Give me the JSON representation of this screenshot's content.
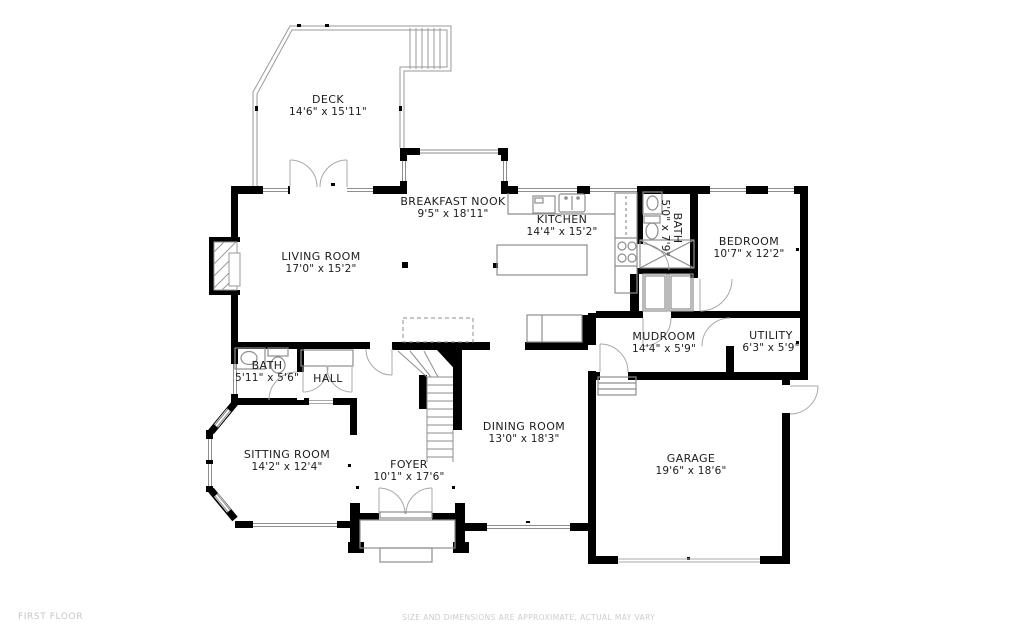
{
  "plan": {
    "floor_label": "FIRST FLOOR",
    "disclaimer": "SIZE AND DIMENSIONS ARE APPROXIMATE, ACTUAL MAY VARY"
  },
  "rooms": [
    {
      "id": "deck",
      "name": "DECK",
      "dims": "14'6\" x 15'11\""
    },
    {
      "id": "breakfast-nook",
      "name": "BREAKFAST NOOK",
      "dims": "9'5\" x 18'11\""
    },
    {
      "id": "kitchen",
      "name": "KITCHEN",
      "dims": "14'4\" x 15'2\""
    },
    {
      "id": "bath-upper",
      "name": "BATH",
      "dims": "5'0\" x 7'9\""
    },
    {
      "id": "bedroom",
      "name": "BEDROOM",
      "dims": "10'7\" x 12'2\""
    },
    {
      "id": "living-room",
      "name": "LIVING ROOM",
      "dims": "17'0\" x 15'2\""
    },
    {
      "id": "mudroom",
      "name": "MUDROOM",
      "dims": "14'4\" x 5'9\""
    },
    {
      "id": "utility",
      "name": "UTILITY",
      "dims": "6'3\" x 5'9\""
    },
    {
      "id": "bath-lower",
      "name": "BATH",
      "dims": "5'11\" x 5'6\""
    },
    {
      "id": "hall",
      "name": "HALL",
      "dims": ""
    },
    {
      "id": "sitting-room",
      "name": "SITTING ROOM",
      "dims": "14'2\" x 12'4\""
    },
    {
      "id": "dining-room",
      "name": "DINING ROOM",
      "dims": "13'0\" x 18'3\""
    },
    {
      "id": "foyer",
      "name": "FOYER",
      "dims": "10'1\" x 17'6\""
    },
    {
      "id": "garage",
      "name": "GARAGE",
      "dims": "19'6\" x 18'6\""
    }
  ],
  "colors": {
    "wall": "#000000",
    "thin_line": "#8e8e8e",
    "arc": "#a8a8a8",
    "text": "#1c1c1c",
    "muted": "#c6c6c6"
  }
}
